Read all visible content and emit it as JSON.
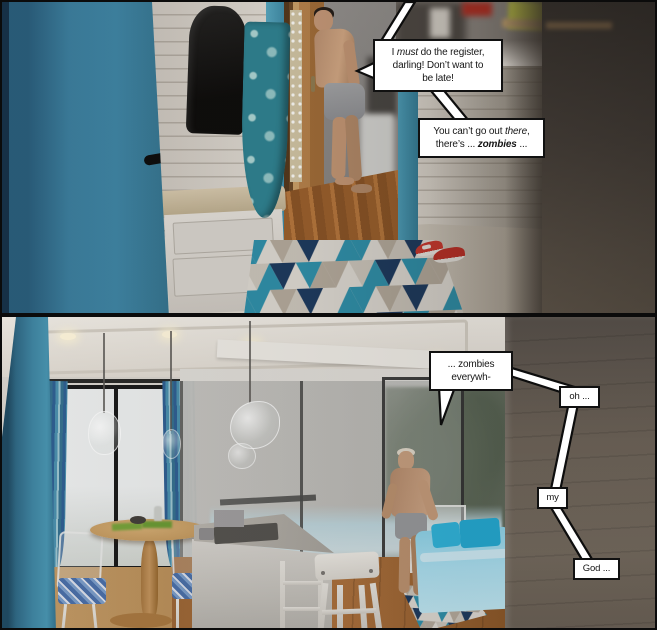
{
  "comic": {
    "panel1": {
      "bubble_must": {
        "segments": [
          {
            "t": "I "
          },
          {
            "t": "must",
            "i": 1
          },
          {
            "t": " do the register,"
          },
          {
            "br": 1
          },
          {
            "t": "darling! Don’t want to"
          },
          {
            "br": 1
          },
          {
            "t": "be late!"
          }
        ]
      },
      "bubble_warning": {
        "segments": [
          {
            "t": "You can’t go out "
          },
          {
            "t": "there",
            "i": 1
          },
          {
            "t": ","
          },
          {
            "br": 1
          },
          {
            "t": "there’s ... "
          },
          {
            "t": "zombies",
            "i": 1,
            "b": 1
          },
          {
            "t": " ..."
          }
        ]
      }
    },
    "panel2": {
      "bubble_everywhere": {
        "segments": [
          {
            "t": "... zombies"
          },
          {
            "br": 1
          },
          {
            "t": "everywh-"
          }
        ]
      },
      "bubble_oh": {
        "text": "oh ..."
      },
      "bubble_my": {
        "text": "my"
      },
      "bubble_god": {
        "text": "God ..."
      }
    },
    "colors": {
      "door_teal": "#3c80a0",
      "accent_teal": "#2f8fa9",
      "rug_navy": "#1d3a5e",
      "sofa_blue": "#9ed9eb",
      "cushion_blue": "#2fb3da",
      "sneaker_red": "#c03028"
    }
  }
}
